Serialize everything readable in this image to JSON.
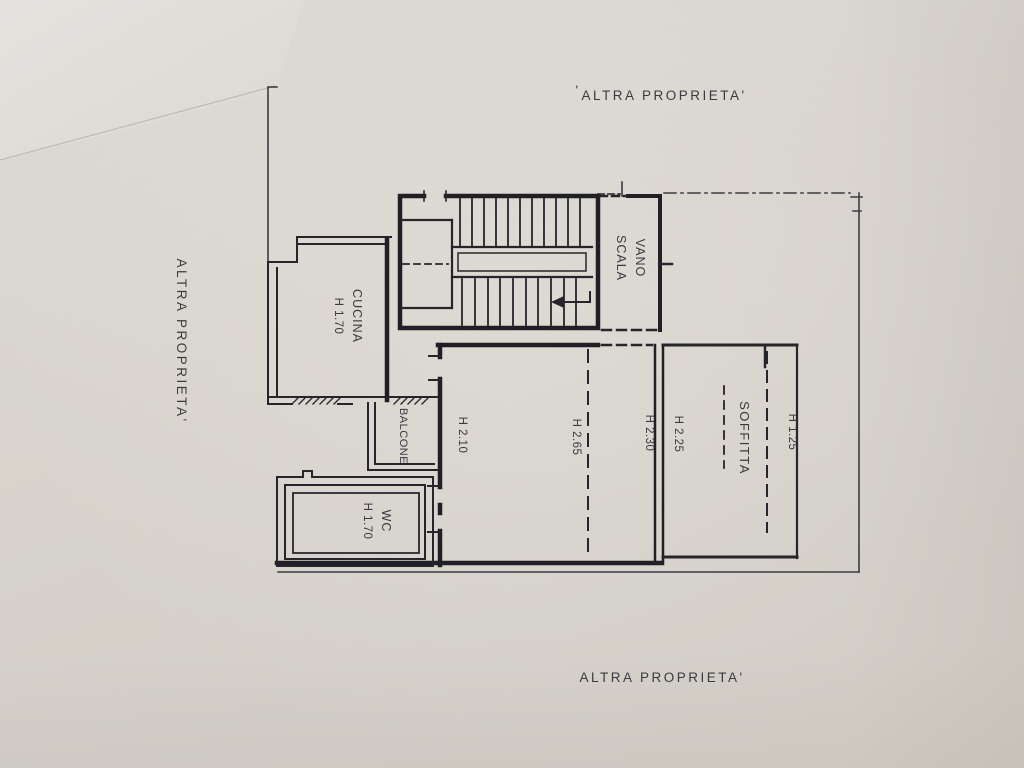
{
  "colors": {
    "paper": "#d7d3cc",
    "ink": "#22222a",
    "text": "#2d2c33"
  },
  "boundary_labels": {
    "top": "ALTRA PROPRIETA'",
    "left": "ALTRA PROPRIETA'",
    "bottom": "ALTRA PROPRIETA'",
    "stray_mark": "'"
  },
  "rooms": {
    "vano_scala": {
      "line1": "VANO",
      "line2": "SCALA"
    },
    "cucina": {
      "name": "CUCINA",
      "height": "H 1.70"
    },
    "balcone": {
      "name": "BALCONE"
    },
    "wc": {
      "name": "WC",
      "height": "H 1.70"
    },
    "soffitta": {
      "name": "SOFFITTA",
      "height": "H 1.25"
    }
  },
  "height_annotations": {
    "room_left": "H 2.10",
    "room_center": "H 2.65",
    "room_right": "H 2.30",
    "soffitta_left": "H 2.25"
  }
}
